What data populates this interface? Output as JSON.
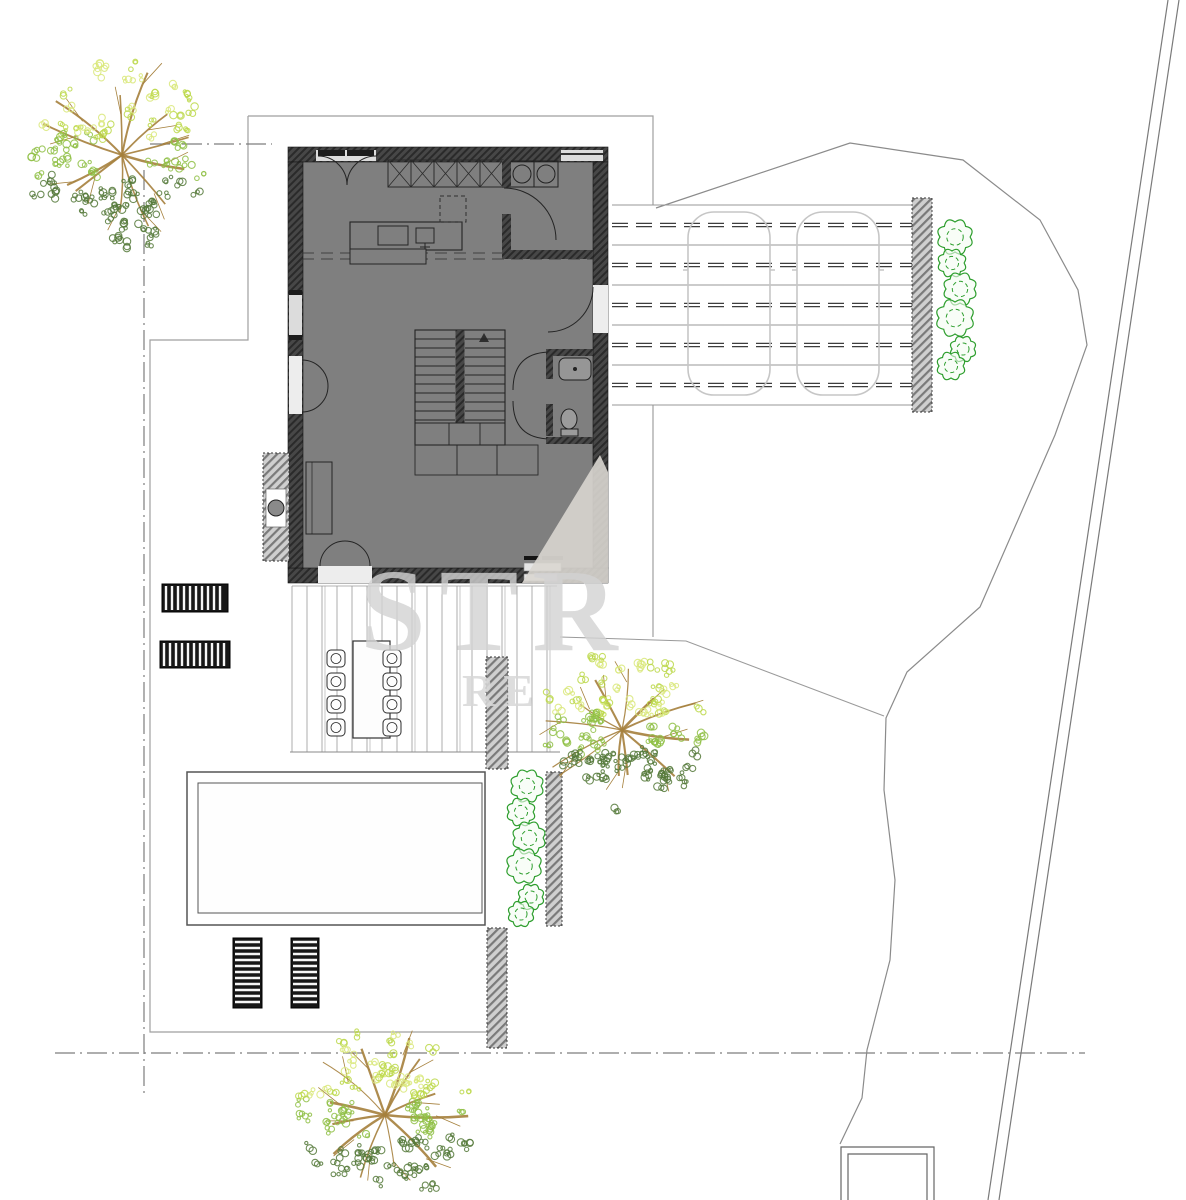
{
  "document": {
    "type": "architectural-site-plan",
    "background": "#ffffff"
  },
  "watermark": {
    "primary": "STR",
    "secondary": "RE",
    "color": "#d3d3d3"
  },
  "palette": {
    "floor": "#7f7f7f",
    "wall_dark": "#474747",
    "wall_hatch": "#2a2a2a",
    "outdoor_wall": "#cfcfcf",
    "line": "#555555",
    "boundary": "#8b8b8b",
    "car": "#c6c6c6",
    "bush": "#2d9e2d",
    "branch": "#a5803c",
    "tree_hi": "#d9e87a",
    "tree_bright": "#bcd84a",
    "tree_mid": "#8fbf45",
    "tree_dark": "#55793a"
  },
  "site": {
    "trees": [
      {
        "id": "tree-northwest",
        "cx": 122,
        "cy": 155,
        "r": 93
      },
      {
        "id": "tree-center",
        "cx": 622,
        "cy": 730,
        "r": 80
      },
      {
        "id": "tree-south",
        "cx": 385,
        "cy": 1115,
        "r": 88
      }
    ],
    "bushes_driveway": [
      [
        955,
        237,
        15
      ],
      [
        952,
        263,
        12
      ],
      [
        960,
        289,
        14
      ],
      [
        955,
        318,
        16
      ],
      [
        963,
        349,
        11
      ],
      [
        951,
        366,
        12
      ]
    ],
    "bushes_pool": [
      [
        527,
        786,
        14
      ],
      [
        521,
        812,
        12
      ],
      [
        529,
        838,
        14
      ],
      [
        524,
        866,
        15
      ],
      [
        531,
        897,
        11
      ],
      [
        521,
        914,
        11
      ]
    ],
    "sun_loungers": [
      {
        "x": 162,
        "y": 584,
        "w": 66,
        "h": 28,
        "o": "v"
      },
      {
        "x": 160,
        "y": 641,
        "w": 70,
        "h": 27,
        "o": "v"
      },
      {
        "x": 233,
        "y": 938,
        "w": 29,
        "h": 70,
        "o": "h"
      },
      {
        "x": 291,
        "y": 938,
        "w": 28,
        "h": 70,
        "o": "h"
      }
    ],
    "dining_chair_count": 8,
    "car_count": 2
  },
  "driveway": {
    "x1": 612,
    "x2": 912,
    "y_top": 205,
    "gap": 20,
    "rows": 11,
    "cars": [
      688,
      797
    ],
    "car_y": 212,
    "car_w": 82,
    "car_h": 183
  },
  "terrace": {
    "x1": 292,
    "x2": 557,
    "step": 15,
    "y1": 586,
    "y2": 752,
    "table": {
      "x": 353,
      "y": 641,
      "w": 37,
      "h": 97
    },
    "chair_cols": [
      336,
      392
    ],
    "chair_rows": [
      650,
      673,
      696,
      719
    ]
  },
  "stairs": {
    "x": 415,
    "y": 330,
    "w": 90,
    "h": 115,
    "treads": 10,
    "gap": 9
  },
  "cabinets": {
    "x": 388,
    "y": 160,
    "cell": 23,
    "cells": 5,
    "h": 27
  }
}
